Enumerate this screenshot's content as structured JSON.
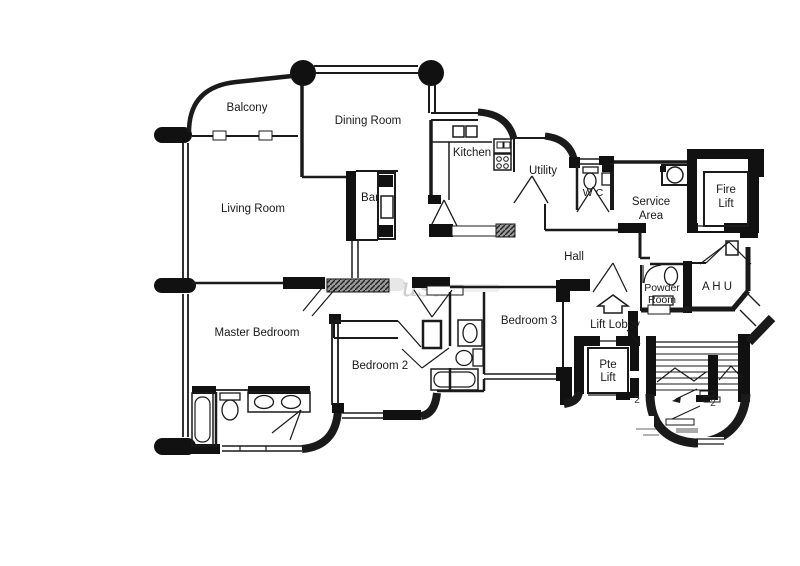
{
  "rooms": {
    "balcony": "Balcony",
    "dining_room": "Dining Room",
    "kitchen": "Kitchen",
    "utility": "Utility",
    "wc": "W C",
    "service_area_line1": "Service",
    "service_area_line2": "Area",
    "fire_lift_line1": "Fire",
    "fire_lift_line2": "Lift",
    "living_room": "Living Room",
    "bar": "Bar",
    "hall": "Hall",
    "ahu": "A H U",
    "powder_room_line1": "Powder",
    "powder_room_line2": "Room",
    "lift_lobby": "Lift Lobby",
    "pte_lift_line1": "Pte",
    "pte_lift_line2": "Lift",
    "master_bedroom": "Master Bedroom",
    "bedroom_2": "Bedroom 2",
    "bedroom_3": "Bedroom 3"
  },
  "annotations": {
    "watermark": "usa",
    "level_mark": "2"
  },
  "colors": {
    "line": "#1a1a1a",
    "wall_fill": "#111111",
    "background": "#ffffff",
    "hatch": "#9a9a9a",
    "watermark": "#cfcfcf"
  }
}
